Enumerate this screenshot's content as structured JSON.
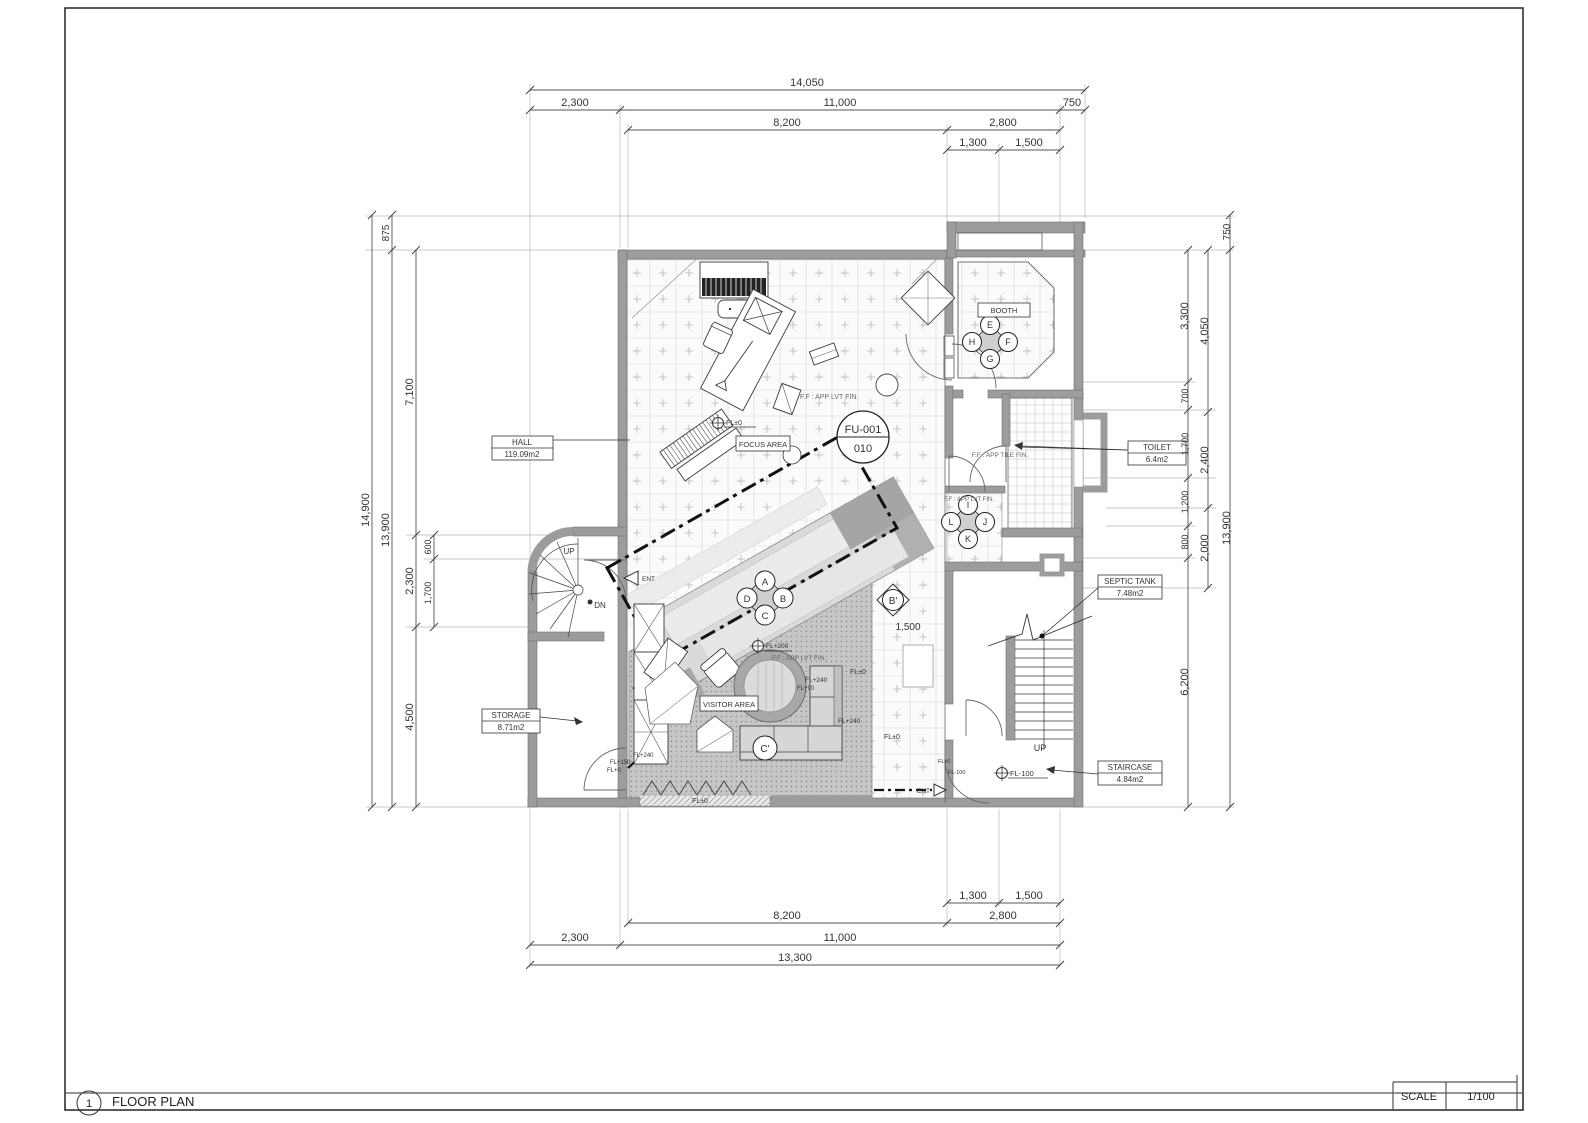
{
  "title_block": {
    "number": "1",
    "title": "FLOOR PLAN",
    "scale_label": "SCALE",
    "scale_value": "1/100"
  },
  "rooms": [
    {
      "name": "HALL",
      "area": "119.09m2"
    },
    {
      "name": "STORAGE",
      "area": "8.71m2"
    },
    {
      "name": "TOILET",
      "area": "6.4m2"
    },
    {
      "name": "SEPTIC TANK",
      "area": "7.48m2"
    },
    {
      "name": "STAIRCASE",
      "area": "4.84m2"
    },
    {
      "name": "BOOTH",
      "area": ""
    },
    {
      "name": "FOCUS AREA",
      "area": ""
    },
    {
      "name": "VISITOR AREA",
      "area": ""
    }
  ],
  "furniture_tag": {
    "code": "FU-001",
    "sheet": "010"
  },
  "seat_labels": [
    "A",
    "B",
    "C",
    "D",
    "E",
    "F",
    "G",
    "H",
    "I",
    "J",
    "K",
    "L"
  ],
  "section_markers": [
    "B'",
    "C'"
  ],
  "circulation": [
    "UP",
    "DN",
    "ENT"
  ],
  "floor_levels": [
    "FL±0",
    "FL+90",
    "FL+150",
    "FL+200",
    "FL+240",
    "FL-100",
    "FL+0"
  ],
  "finish_notes": [
    "F.F : APP LVT FIN.",
    "F.F : APP TILE FIN."
  ],
  "dimensions_mm": {
    "top": [
      "14,050",
      "2,300",
      "11,000",
      "750",
      "8,200",
      "2,800",
      "1,300",
      "1,500"
    ],
    "bottom": [
      "1,300",
      "1,500",
      "8,200",
      "2,800",
      "2,300",
      "11,000",
      "13,300"
    ],
    "left": [
      "14,900",
      "875",
      "13,900",
      "7,100",
      "600",
      "2,300",
      "1,700",
      "4,500"
    ],
    "right": [
      "750",
      "13,900",
      "4,050",
      "2,400",
      "2,000",
      "3,300",
      "700",
      "1,700",
      "1,200",
      "800",
      "6,200"
    ],
    "internal": [
      "1,500"
    ]
  },
  "annotations": [
    {
      "n": "dim-top-14050",
      "x": 807,
      "y": 86,
      "t": "14,050"
    },
    {
      "n": "dim-top-2300",
      "x": 575,
      "y": 106,
      "t": "2,300"
    },
    {
      "n": "dim-top-11000",
      "x": 840,
      "y": 106,
      "t": "11,000"
    },
    {
      "n": "dim-top-750",
      "x": 1072,
      "y": 106,
      "t": "750"
    },
    {
      "n": "dim-top-8200",
      "x": 787,
      "y": 126,
      "t": "8,200"
    },
    {
      "n": "dim-top-2800",
      "x": 1003,
      "y": 126,
      "t": "2,800"
    },
    {
      "n": "dim-top-1300",
      "x": 973,
      "y": 146,
      "t": "1,300"
    },
    {
      "n": "dim-top-1500",
      "x": 1029,
      "y": 146,
      "t": "1,500"
    },
    {
      "n": "dim-bot-1300",
      "x": 973,
      "y": 899,
      "t": "1,300"
    },
    {
      "n": "dim-bot-1500",
      "x": 1029,
      "y": 899,
      "t": "1,500"
    },
    {
      "n": "dim-bot-8200",
      "x": 787,
      "y": 919,
      "t": "8,200"
    },
    {
      "n": "dim-bot-2800",
      "x": 1003,
      "y": 919,
      "t": "2,800"
    },
    {
      "n": "dim-bot-2300",
      "x": 575,
      "y": 941,
      "t": "2,300"
    },
    {
      "n": "dim-bot-11000",
      "x": 840,
      "y": 941,
      "t": "11,000"
    },
    {
      "n": "dim-bot-13300",
      "x": 795,
      "y": 961,
      "t": "13,300"
    },
    {
      "n": "dim-left-14900",
      "x": 369,
      "y": 510,
      "t": "14,900",
      "r": -90
    },
    {
      "n": "dim-left-875",
      "x": 389,
      "y": 233,
      "t": "875",
      "r": -90,
      "s": 10
    },
    {
      "n": "dim-left-13900",
      "x": 389,
      "y": 530,
      "t": "13,900",
      "r": -90
    },
    {
      "n": "dim-left-7100",
      "x": 413,
      "y": 392,
      "t": "7,100",
      "r": -90
    },
    {
      "n": "dim-left-2300",
      "x": 413,
      "y": 581,
      "t": "2,300",
      "r": -90
    },
    {
      "n": "dim-left-4500",
      "x": 413,
      "y": 717,
      "t": "4,500",
      "r": -90
    },
    {
      "n": "dim-left-600",
      "x": 431,
      "y": 547,
      "t": "600",
      "r": -90,
      "s": 9
    },
    {
      "n": "dim-left-1700",
      "x": 431,
      "y": 593,
      "t": "1,700",
      "r": -90,
      "s": 9
    },
    {
      "n": "dim-right-750",
      "x": 1230,
      "y": 232,
      "t": "750",
      "r": -90,
      "s": 10
    },
    {
      "n": "dim-right-13900",
      "x": 1230,
      "y": 528,
      "t": "13,900",
      "r": -90
    },
    {
      "n": "dim-right-4050",
      "x": 1208,
      "y": 331,
      "t": "4,050",
      "r": -90
    },
    {
      "n": "dim-right-2400",
      "x": 1208,
      "y": 460,
      "t": "2,400",
      "r": -90
    },
    {
      "n": "dim-right-2000",
      "x": 1208,
      "y": 548,
      "t": "2,000",
      "r": -90
    },
    {
      "n": "dim-right-3300",
      "x": 1188,
      "y": 316,
      "t": "3,300",
      "r": -90
    },
    {
      "n": "dim-right-700",
      "x": 1188,
      "y": 396,
      "t": "700",
      "r": -90,
      "s": 9
    },
    {
      "n": "dim-right-1700",
      "x": 1188,
      "y": 444,
      "t": "1,700",
      "r": -90,
      "s": 9
    },
    {
      "n": "dim-right-1200",
      "x": 1188,
      "y": 502,
      "t": "1,200",
      "r": -90,
      "s": 9
    },
    {
      "n": "dim-right-800",
      "x": 1188,
      "y": 542,
      "t": "800",
      "r": -90,
      "s": 9
    },
    {
      "n": "dim-right-6200",
      "x": 1188,
      "y": 682,
      "t": "6,200",
      "r": -90
    },
    {
      "n": "dim-plan-1500",
      "x": 908,
      "y": 630,
      "t": "1,500",
      "s": 10
    },
    {
      "n": "room-hall-name",
      "x": 522,
      "y": 445,
      "t": "HALL",
      "s": 8
    },
    {
      "n": "room-hall-area",
      "x": 522,
      "y": 457,
      "t": "119.09m2",
      "s": 8
    },
    {
      "n": "room-storage-name",
      "x": 511,
      "y": 718,
      "t": "STORAGE",
      "s": 8
    },
    {
      "n": "room-storage-area",
      "x": 511,
      "y": 730,
      "t": "8.71m2",
      "s": 8
    },
    {
      "n": "room-toilet-name",
      "x": 1157,
      "y": 450,
      "t": "TOILET",
      "s": 8
    },
    {
      "n": "room-toilet-area",
      "x": 1157,
      "y": 462,
      "t": "6.4m2",
      "s": 8
    },
    {
      "n": "room-septic-name",
      "x": 1130,
      "y": 584,
      "t": "SEPTIC TANK",
      "s": 8
    },
    {
      "n": "room-septic-area",
      "x": 1130,
      "y": 596,
      "t": "7.48m2",
      "s": 8
    },
    {
      "n": "room-staircase-name",
      "x": 1130,
      "y": 770,
      "t": "STAIRCASE",
      "s": 8
    },
    {
      "n": "room-staircase-area",
      "x": 1130,
      "y": 782,
      "t": "4.84m2",
      "s": 8
    },
    {
      "n": "room-booth-name",
      "x": 1004,
      "y": 313,
      "t": "BOOTH",
      "s": 7.5
    },
    {
      "n": "room-focus-name",
      "x": 763,
      "y": 447,
      "t": "FOCUS AREA",
      "s": 7.5
    },
    {
      "n": "room-visitor-name",
      "x": 729,
      "y": 707,
      "t": "VISITOR AREA",
      "s": 7.5
    },
    {
      "n": "tag-fu-code",
      "x": 863,
      "y": 433,
      "t": "FU-001",
      "s": 11
    },
    {
      "n": "tag-fu-sheet",
      "x": 863,
      "y": 452,
      "t": "010",
      "s": 11
    },
    {
      "n": "seat-a",
      "x": 765,
      "y": 585,
      "t": "A",
      "s": 9.5
    },
    {
      "n": "seat-b",
      "x": 783,
      "y": 602,
      "t": "B",
      "s": 9.5
    },
    {
      "n": "seat-c",
      "x": 765,
      "y": 619,
      "t": "C",
      "s": 9.5
    },
    {
      "n": "seat-d",
      "x": 747,
      "y": 602,
      "t": "D",
      "s": 9.5
    },
    {
      "n": "seat-e",
      "x": 990,
      "y": 328,
      "t": "E",
      "s": 9
    },
    {
      "n": "seat-f",
      "x": 1008,
      "y": 345,
      "t": "F",
      "s": 9
    },
    {
      "n": "seat-g",
      "x": 990,
      "y": 362,
      "t": "G",
      "s": 9
    },
    {
      "n": "seat-h",
      "x": 972,
      "y": 345,
      "t": "H",
      "s": 9
    },
    {
      "n": "seat-i",
      "x": 968,
      "y": 508,
      "t": "I",
      "s": 9
    },
    {
      "n": "seat-j",
      "x": 985,
      "y": 525,
      "t": "J",
      "s": 9
    },
    {
      "n": "seat-k",
      "x": 968,
      "y": 542,
      "t": "K",
      "s": 9
    },
    {
      "n": "seat-l",
      "x": 951,
      "y": 525,
      "t": "L",
      "s": 9
    },
    {
      "n": "section-b",
      "x": 893,
      "y": 604,
      "t": "B'",
      "s": 10
    },
    {
      "n": "section-c",
      "x": 765,
      "y": 752,
      "t": "C'",
      "s": 10
    },
    {
      "n": "lvl-hall",
      "x": 726,
      "y": 425,
      "t": "FL±0",
      "s": 7,
      "a": "start"
    },
    {
      "n": "fin-hall",
      "x": 800,
      "y": 399,
      "t": "F.F : APP LVT FIN.",
      "s": 7,
      "a": "start",
      "c": "#666"
    },
    {
      "n": "lvl-stage",
      "x": 766,
      "y": 648,
      "t": "FL+200",
      "s": 6.5,
      "a": "start"
    },
    {
      "n": "fin-visitor",
      "x": 772,
      "y": 660,
      "t": "F.F : APP LVT FIN.",
      "s": 6.5,
      "a": "start",
      "c": "#666"
    },
    {
      "n": "lvl-sofa-1",
      "x": 805,
      "y": 682,
      "t": "FL+240",
      "s": 6.5,
      "a": "start"
    },
    {
      "n": "lvl-sofa-2",
      "x": 797,
      "y": 690,
      "t": "FL+90",
      "s": 6,
      "a": "start"
    },
    {
      "n": "lvl-right-1",
      "x": 850,
      "y": 674,
      "t": "FL±0",
      "s": 7,
      "a": "start"
    },
    {
      "n": "lvl-sofa-3",
      "x": 838,
      "y": 723,
      "t": "FL+240",
      "s": 6.5,
      "a": "start"
    },
    {
      "n": "lvl-right-2",
      "x": 884,
      "y": 739,
      "t": "FL±0",
      "s": 7,
      "a": "start"
    },
    {
      "n": "lvl-strip",
      "x": 700,
      "y": 803,
      "t": "FL±0",
      "s": 7
    },
    {
      "n": "lvl-door-1",
      "x": 610,
      "y": 764,
      "t": "FL+150",
      "s": 6,
      "a": "start"
    },
    {
      "n": "lvl-door-2",
      "x": 607,
      "y": 772,
      "t": "FL+0",
      "s": 6,
      "a": "start"
    },
    {
      "n": "lvl-door-3",
      "x": 633,
      "y": 757,
      "t": "FL+240",
      "s": 6,
      "a": "start"
    },
    {
      "n": "lvl-stair",
      "x": 1010,
      "y": 776,
      "t": "FL-100",
      "s": 7.5,
      "a": "start"
    },
    {
      "n": "lvl-ent-1",
      "x": 938,
      "y": 763,
      "t": "FL±0",
      "s": 5.5,
      "a": "start"
    },
    {
      "n": "lvl-ent-2",
      "x": 948,
      "y": 774,
      "t": "FL-100",
      "s": 5.5,
      "a": "start"
    },
    {
      "n": "fin-toilet",
      "x": 1000,
      "y": 457,
      "t": "F.F : APP TILE FIN.",
      "s": 6.5,
      "c": "#666"
    },
    {
      "n": "fin-nook",
      "x": 944,
      "y": 501,
      "t": "F.F : APP LVT FIN.",
      "s": 6,
      "a": "start",
      "c": "#666"
    },
    {
      "n": "spiral-up",
      "x": 569,
      "y": 554,
      "t": "UP",
      "s": 8
    },
    {
      "n": "spiral-dn",
      "x": 600,
      "y": 608,
      "t": "DN",
      "s": 8
    },
    {
      "n": "stair-up",
      "x": 1040,
      "y": 751,
      "t": "UP",
      "s": 9
    },
    {
      "n": "ent-left",
      "x": 642,
      "y": 581,
      "t": "ENT",
      "s": 6.5,
      "a": "start"
    },
    {
      "n": "ent-bottom",
      "x": 930,
      "y": 793,
      "t": "ENT",
      "s": 6.5,
      "a": "end"
    }
  ]
}
